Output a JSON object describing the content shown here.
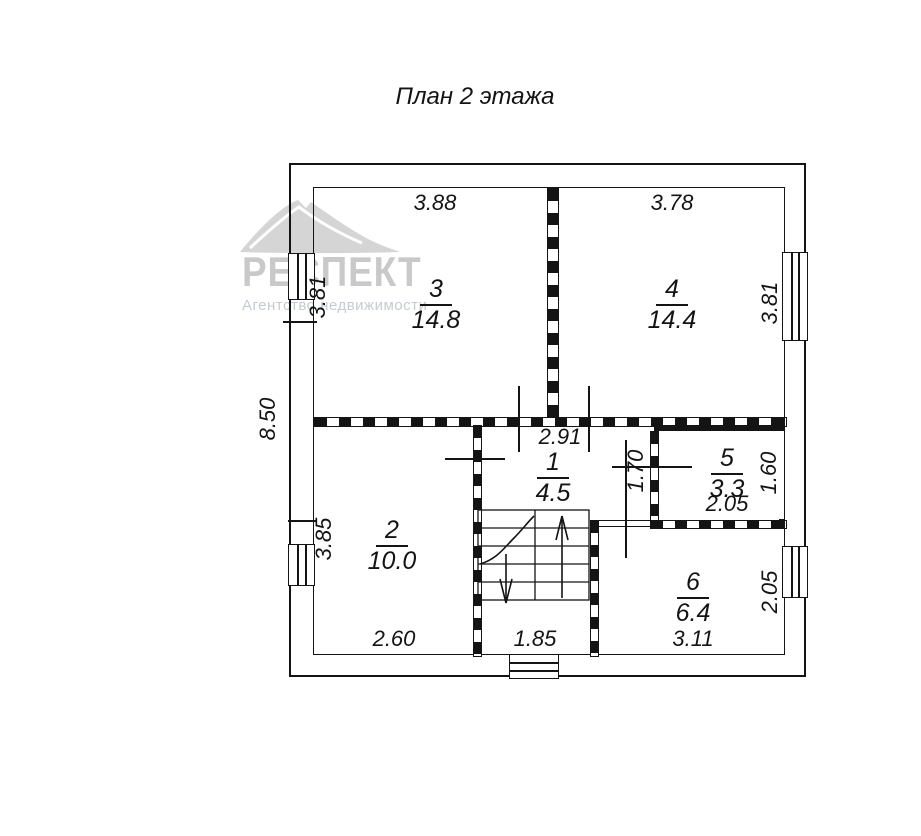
{
  "title": "План 2 этажа",
  "watermark": {
    "brand": "РЕСПЕКТ",
    "subtitle": "Агентство недвижимости"
  },
  "colors": {
    "line": "#141414",
    "watermark": "#c9c9c9",
    "watermark_subtitle": "#c6cad2"
  },
  "plan": {
    "rooms": {
      "hall": {
        "number": "1",
        "area": "4.5"
      },
      "room2": {
        "number": "2",
        "area": "10.0"
      },
      "room3": {
        "number": "3",
        "area": "14.8"
      },
      "room4": {
        "number": "4",
        "area": "14.4"
      },
      "room5": {
        "number": "5",
        "area": "3.3"
      },
      "room6": {
        "number": "6",
        "area": "6.4"
      }
    },
    "dims": {
      "room3_width": "3.88",
      "room4_width": "3.78",
      "room3_height": "3.81",
      "room4_height": "3.81",
      "overall_height": "8.50",
      "hall_width": "2.91",
      "hall_height": "1.70",
      "room5_width": "2.05",
      "room5_height": "1.60",
      "room2_width": "2.60",
      "room2_height": "3.85",
      "room6_width": "3.11",
      "room6_height": "2.05",
      "stair_bay_width": "1.85"
    }
  }
}
